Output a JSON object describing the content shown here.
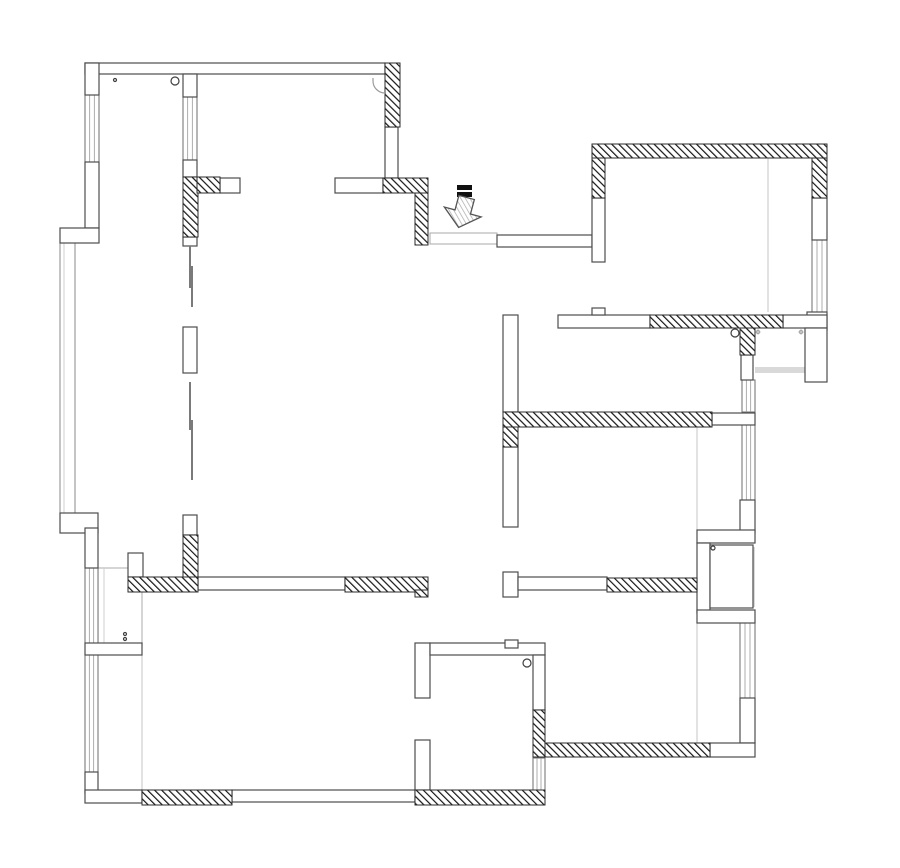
{
  "canvas": {
    "width": 900,
    "height": 868,
    "background": "#ffffff"
  },
  "colors": {
    "wall_outline": "#4d4d4d",
    "hatch_line": "#151515",
    "hatch_outline": "#2b2b2b",
    "window_frame": "#6e6e6e",
    "window_pane": "#9a9a9a",
    "faint": "#cfcfcf",
    "rail": "#8a8a8a",
    "gray_fill": "#d9d9d9",
    "leaf": "#7a7a7a",
    "symbol": "#3f3f3f",
    "arrow_outline": "#555555",
    "arrow_hatch": "#a8a8a8",
    "threshold": "#a9a9a9",
    "wardrobe": "#b9b9b9"
  },
  "layers": {
    "hatched_walls": [
      [
        385,
        63,
        15,
        64
      ],
      [
        183,
        177,
        15,
        60
      ],
      [
        197,
        177,
        23,
        16
      ],
      [
        383,
        178,
        45,
        15
      ],
      [
        415,
        193,
        13,
        52
      ],
      [
        592,
        144,
        235,
        14
      ],
      [
        592,
        158,
        13,
        40
      ],
      [
        812,
        158,
        15,
        40
      ],
      [
        650,
        315,
        133,
        13
      ],
      [
        740,
        328,
        15,
        27
      ],
      [
        503,
        412,
        209,
        15
      ],
      [
        503,
        427,
        15,
        20
      ],
      [
        183,
        535,
        15,
        42
      ],
      [
        128,
        577,
        70,
        15
      ],
      [
        345,
        577,
        83,
        15
      ],
      [
        415,
        590,
        13,
        7
      ],
      [
        607,
        578,
        90,
        14
      ],
      [
        533,
        710,
        12,
        47
      ],
      [
        545,
        743,
        165,
        14
      ],
      [
        142,
        790,
        90,
        15
      ],
      [
        415,
        790,
        130,
        15
      ]
    ],
    "white_walls": [
      [
        85,
        63,
        300,
        11
      ],
      [
        85,
        63,
        14,
        32
      ],
      [
        85,
        162,
        14,
        66
      ],
      [
        60,
        228,
        39,
        15
      ],
      [
        60,
        513,
        38,
        20
      ],
      [
        85,
        528,
        13,
        40
      ],
      [
        183,
        74,
        14,
        23
      ],
      [
        183,
        160,
        14,
        17
      ],
      [
        183,
        237,
        14,
        9
      ],
      [
        183,
        327,
        14,
        46
      ],
      [
        183,
        515,
        14,
        20
      ],
      [
        385,
        127,
        13,
        51
      ],
      [
        335,
        178,
        48,
        15
      ],
      [
        220,
        178,
        20,
        15
      ],
      [
        497,
        235,
        95,
        12
      ],
      [
        592,
        198,
        13,
        64
      ],
      [
        812,
        198,
        15,
        42
      ],
      [
        807,
        312,
        20,
        18
      ],
      [
        558,
        315,
        92,
        13
      ],
      [
        783,
        315,
        44,
        13
      ],
      [
        592,
        308,
        13,
        7
      ],
      [
        805,
        328,
        22,
        54
      ],
      [
        741,
        355,
        12,
        25
      ],
      [
        503,
        315,
        15,
        97
      ],
      [
        503,
        447,
        15,
        80
      ],
      [
        712,
        413,
        43,
        12
      ],
      [
        740,
        500,
        15,
        33
      ],
      [
        697,
        530,
        58,
        13
      ],
      [
        697,
        543,
        13,
        70
      ],
      [
        697,
        610,
        58,
        13
      ],
      [
        740,
        698,
        15,
        45
      ],
      [
        710,
        743,
        45,
        14
      ],
      [
        198,
        577,
        147,
        13
      ],
      [
        503,
        572,
        15,
        25
      ],
      [
        518,
        577,
        89,
        13
      ],
      [
        128,
        553,
        15,
        24
      ],
      [
        85,
        643,
        57,
        12
      ],
      [
        85,
        772,
        13,
        21
      ],
      [
        85,
        790,
        57,
        13
      ],
      [
        232,
        790,
        183,
        12
      ],
      [
        415,
        643,
        15,
        55
      ],
      [
        415,
        740,
        15,
        50
      ],
      [
        430,
        643,
        115,
        12
      ],
      [
        505,
        640,
        13,
        8
      ],
      [
        533,
        655,
        12,
        55
      ],
      [
        710,
        545,
        43,
        63
      ]
    ],
    "windows": [
      [
        85,
        95,
        14,
        67
      ],
      [
        183,
        97,
        14,
        63
      ],
      [
        812,
        240,
        15,
        72
      ],
      [
        742,
        380,
        13,
        32
      ],
      [
        742,
        425,
        13,
        75
      ],
      [
        740,
        623,
        15,
        75
      ],
      [
        533,
        758,
        12,
        32
      ],
      [
        85,
        655,
        13,
        117
      ],
      [
        85,
        568,
        13,
        75
      ]
    ],
    "rail": [
      60,
      243,
      15,
      270
    ],
    "gray_fills": [
      [
        755,
        367,
        50,
        6
      ],
      [
        750,
        547,
        5,
        60
      ]
    ],
    "faint_lines": [
      [
        697,
        427,
        697,
        530
      ],
      [
        697,
        623,
        697,
        743
      ],
      [
        768,
        158,
        768,
        312
      ],
      [
        142,
        655,
        142,
        790
      ]
    ],
    "door_leaves": [
      [
        189,
        246,
        2,
        42
      ],
      [
        191,
        266,
        2,
        41
      ],
      [
        189,
        382,
        2,
        48
      ],
      [
        191,
        420,
        2,
        60
      ]
    ],
    "threshold": [
      430,
      233,
      67,
      11
    ],
    "wardrobe": [
      98,
      568,
      44,
      77
    ],
    "corner_arc": "M 385 93 A 12 12 0 0 1 373 81 L 373 78",
    "circles": [
      [
        115,
        80,
        1.5
      ],
      [
        175,
        81,
        4
      ],
      [
        735,
        333,
        4
      ],
      [
        527,
        663,
        4
      ],
      [
        713,
        548,
        2
      ],
      [
        125,
        634,
        1.5
      ],
      [
        125,
        639,
        1.5
      ]
    ],
    "stars": [
      [
        758,
        332
      ],
      [
        801,
        332
      ]
    ],
    "entrance": {
      "bars": [
        [
          457,
          185,
          15,
          5
        ],
        [
          457,
          192,
          15,
          5
        ]
      ],
      "arrow_points": "-8,-14 8,-14 8,1 19,1 0,17 -19,1 -8,1",
      "arrow_tx": 463,
      "arrow_ty": 211,
      "arrow_rotation": 15
    }
  }
}
